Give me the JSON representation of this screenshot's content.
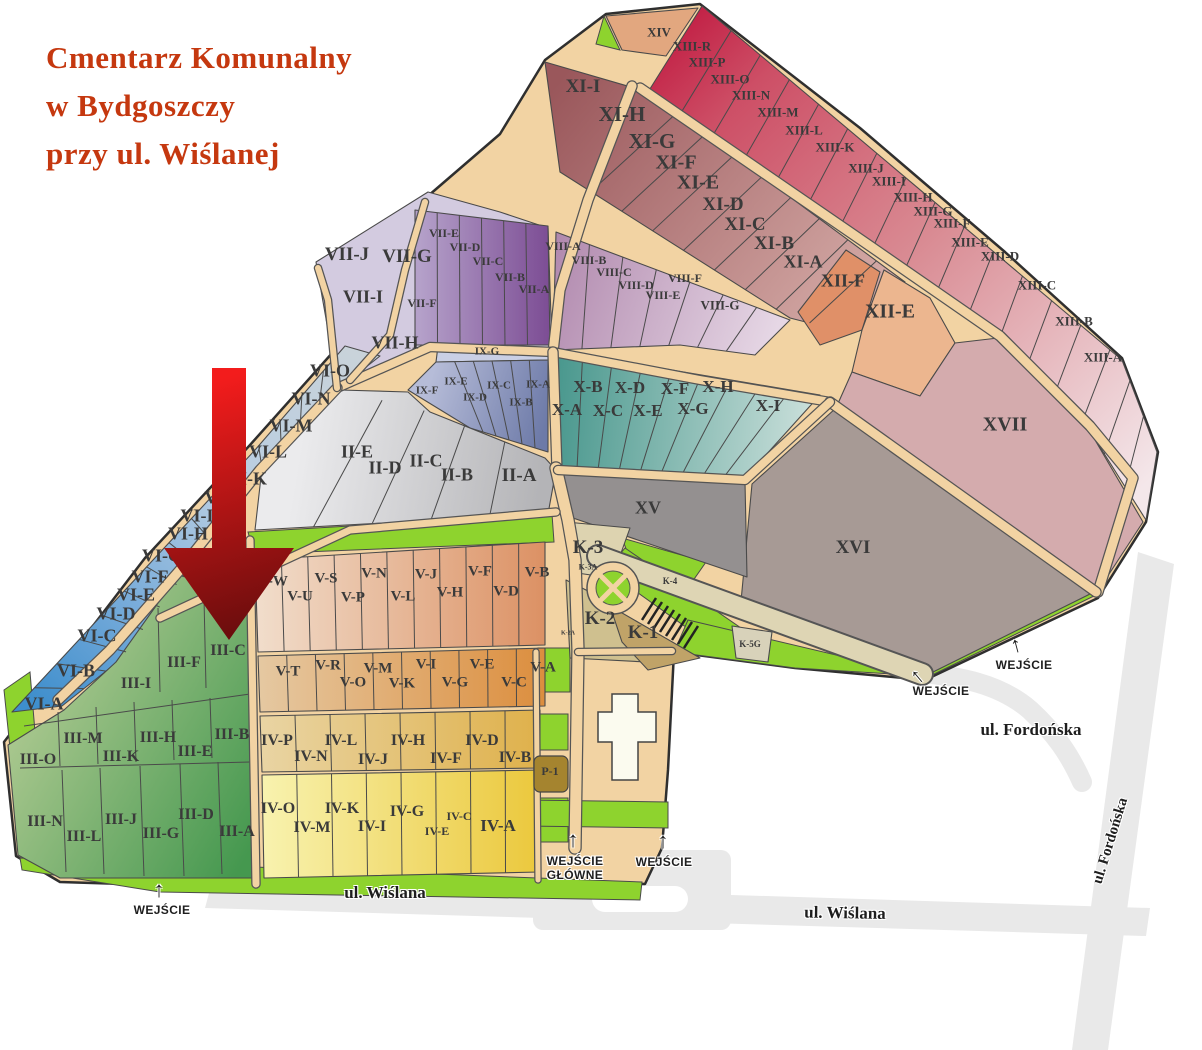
{
  "palette": {
    "title": "#c5380f",
    "label": "#3a3a3a",
    "road": "#f2d3a3",
    "lawn": "#8ed32e",
    "street": "#e9e9e9",
    "arrow_top": "#f31c1c",
    "arrow_bottom": "#6b0d0d"
  },
  "title": {
    "lines": [
      "Cmentarz Komunalny",
      "w Bydgoszczy",
      "przy ul. Wiślanej"
    ]
  },
  "sections": [
    {
      "t": "XIV",
      "x": 659,
      "y": 33,
      "s": 13
    },
    {
      "t": "XIII-R",
      "x": 692,
      "y": 47,
      "s": 13
    },
    {
      "t": "XIII-P",
      "x": 707,
      "y": 63,
      "s": 13
    },
    {
      "t": "XIII-O",
      "x": 730,
      "y": 80,
      "s": 13
    },
    {
      "t": "XIII-N",
      "x": 751,
      "y": 96,
      "s": 13
    },
    {
      "t": "XIII-M",
      "x": 778,
      "y": 113,
      "s": 13
    },
    {
      "t": "XIII-L",
      "x": 804,
      "y": 131,
      "s": 13
    },
    {
      "t": "XIII-K",
      "x": 835,
      "y": 148,
      "s": 13
    },
    {
      "t": "XIII-J",
      "x": 866,
      "y": 169,
      "s": 13
    },
    {
      "t": "XIII-I",
      "x": 889,
      "y": 182,
      "s": 13
    },
    {
      "t": "XIII-H",
      "x": 913,
      "y": 198,
      "s": 13
    },
    {
      "t": "XIII-G",
      "x": 933,
      "y": 212,
      "s": 13
    },
    {
      "t": "XIII-F",
      "x": 952,
      "y": 224,
      "s": 13
    },
    {
      "t": "XIII-E",
      "x": 970,
      "y": 243,
      "s": 13
    },
    {
      "t": "XIII-D",
      "x": 1000,
      "y": 257,
      "s": 13
    },
    {
      "t": "XIII-C",
      "x": 1037,
      "y": 286,
      "s": 13
    },
    {
      "t": "XIII-B",
      "x": 1074,
      "y": 322,
      "s": 13
    },
    {
      "t": "XIII-A",
      "x": 1103,
      "y": 358,
      "s": 13
    },
    {
      "t": "XI-I",
      "x": 583,
      "y": 87,
      "s": 19
    },
    {
      "t": "XI-H",
      "x": 622,
      "y": 114,
      "s": 21
    },
    {
      "t": "XI-G",
      "x": 652,
      "y": 141,
      "s": 21
    },
    {
      "t": "XI-F",
      "x": 676,
      "y": 163,
      "s": 20
    },
    {
      "t": "XI-E",
      "x": 698,
      "y": 183,
      "s": 20
    },
    {
      "t": "XI-D",
      "x": 723,
      "y": 205,
      "s": 19
    },
    {
      "t": "XI-C",
      "x": 745,
      "y": 225,
      "s": 19
    },
    {
      "t": "XI-B",
      "x": 774,
      "y": 244,
      "s": 19
    },
    {
      "t": "XI-A",
      "x": 803,
      "y": 262,
      "s": 18
    },
    {
      "t": "XII-F",
      "x": 843,
      "y": 281,
      "s": 18
    },
    {
      "t": "XII-E",
      "x": 890,
      "y": 312,
      "s": 20
    },
    {
      "t": "XVII",
      "x": 1005,
      "y": 425,
      "s": 20
    },
    {
      "t": "XVI",
      "x": 853,
      "y": 548,
      "s": 19
    },
    {
      "t": "XV",
      "x": 648,
      "y": 508,
      "s": 18
    },
    {
      "t": "VII-J",
      "x": 347,
      "y": 255,
      "s": 19
    },
    {
      "t": "VII-G",
      "x": 407,
      "y": 257,
      "s": 19
    },
    {
      "t": "VII-I",
      "x": 363,
      "y": 297,
      "s": 18
    },
    {
      "t": "VII-E",
      "x": 444,
      "y": 234,
      "s": 12
    },
    {
      "t": "VII-D",
      "x": 465,
      "y": 248,
      "s": 12
    },
    {
      "t": "VII-C",
      "x": 488,
      "y": 262,
      "s": 12
    },
    {
      "t": "VII-B",
      "x": 510,
      "y": 278,
      "s": 12
    },
    {
      "t": "VII-A",
      "x": 534,
      "y": 290,
      "s": 12
    },
    {
      "t": "VII-F",
      "x": 422,
      "y": 304,
      "s": 12
    },
    {
      "t": "VII-H",
      "x": 395,
      "y": 343,
      "s": 18
    },
    {
      "t": "VIII-A",
      "x": 563,
      "y": 247,
      "s": 12
    },
    {
      "t": "VIII-B",
      "x": 589,
      "y": 261,
      "s": 12
    },
    {
      "t": "VIII-C",
      "x": 614,
      "y": 273,
      "s": 12
    },
    {
      "t": "VIII-D",
      "x": 636,
      "y": 286,
      "s": 12
    },
    {
      "t": "VIII-E",
      "x": 663,
      "y": 296,
      "s": 12
    },
    {
      "t": "VIII-F",
      "x": 685,
      "y": 279,
      "s": 12
    },
    {
      "t": "VIII-G",
      "x": 720,
      "y": 306,
      "s": 13
    },
    {
      "t": "IX-G",
      "x": 487,
      "y": 352,
      "s": 11
    },
    {
      "t": "IX-F",
      "x": 427,
      "y": 391,
      "s": 11
    },
    {
      "t": "IX-E",
      "x": 456,
      "y": 382,
      "s": 11
    },
    {
      "t": "IX-D",
      "x": 475,
      "y": 398,
      "s": 11
    },
    {
      "t": "IX-C",
      "x": 499,
      "y": 386,
      "s": 11
    },
    {
      "t": "IX-B",
      "x": 521,
      "y": 403,
      "s": 11
    },
    {
      "t": "IX-A",
      "x": 538,
      "y": 385,
      "s": 11
    },
    {
      "t": "X-A",
      "x": 567,
      "y": 410,
      "s": 17
    },
    {
      "t": "X-B",
      "x": 588,
      "y": 387,
      "s": 17
    },
    {
      "t": "X-C",
      "x": 608,
      "y": 411,
      "s": 17
    },
    {
      "t": "X-D",
      "x": 630,
      "y": 388,
      "s": 17
    },
    {
      "t": "X-E",
      "x": 648,
      "y": 411,
      "s": 17
    },
    {
      "t": "X-F",
      "x": 675,
      "y": 389,
      "s": 17
    },
    {
      "t": "X-G",
      "x": 693,
      "y": 409,
      "s": 17
    },
    {
      "t": "X-H",
      "x": 718,
      "y": 387,
      "s": 17
    },
    {
      "t": "X-I",
      "x": 768,
      "y": 406,
      "s": 17
    },
    {
      "t": "VI-O",
      "x": 330,
      "y": 371,
      "s": 18
    },
    {
      "t": "VI-N",
      "x": 311,
      "y": 399,
      "s": 18
    },
    {
      "t": "VI-M",
      "x": 291,
      "y": 426,
      "s": 18
    },
    {
      "t": "VI-L",
      "x": 268,
      "y": 452,
      "s": 18
    },
    {
      "t": "VI-K",
      "x": 247,
      "y": 479,
      "s": 18
    },
    {
      "t": "VI-J",
      "x": 222,
      "y": 498,
      "s": 18
    },
    {
      "t": "VI-I",
      "x": 197,
      "y": 516,
      "s": 18
    },
    {
      "t": "VI-H",
      "x": 188,
      "y": 534,
      "s": 18
    },
    {
      "t": "VI-G",
      "x": 162,
      "y": 556,
      "s": 18
    },
    {
      "t": "VI-F",
      "x": 150,
      "y": 577,
      "s": 18
    },
    {
      "t": "VI-E",
      "x": 136,
      "y": 595,
      "s": 18
    },
    {
      "t": "VI-D",
      "x": 116,
      "y": 614,
      "s": 18
    },
    {
      "t": "VI-C",
      "x": 97,
      "y": 636,
      "s": 18
    },
    {
      "t": "VI-B",
      "x": 76,
      "y": 671,
      "s": 18
    },
    {
      "t": "VI-A",
      "x": 44,
      "y": 704,
      "s": 18
    },
    {
      "t": "II-E",
      "x": 357,
      "y": 452,
      "s": 18
    },
    {
      "t": "II-D",
      "x": 385,
      "y": 468,
      "s": 18
    },
    {
      "t": "II-C",
      "x": 426,
      "y": 461,
      "s": 18
    },
    {
      "t": "II-B",
      "x": 457,
      "y": 475,
      "s": 18
    },
    {
      "t": "II-A",
      "x": 519,
      "y": 476,
      "s": 19
    },
    {
      "t": "K-3",
      "x": 588,
      "y": 548,
      "s": 19
    },
    {
      "t": "K-3A",
      "x": 588,
      "y": 567,
      "s": 8
    },
    {
      "t": "K-4",
      "x": 670,
      "y": 581,
      "s": 9
    },
    {
      "t": "K-2",
      "x": 600,
      "y": 619,
      "s": 19
    },
    {
      "t": "K-1",
      "x": 643,
      "y": 633,
      "s": 19
    },
    {
      "t": "K-2A",
      "x": 568,
      "y": 634,
      "s": 6
    },
    {
      "t": "K-5G",
      "x": 750,
      "y": 644,
      "s": 9
    },
    {
      "t": "V-W",
      "x": 273,
      "y": 582,
      "s": 15
    },
    {
      "t": "V-U",
      "x": 300,
      "y": 597,
      "s": 15
    },
    {
      "t": "V-S",
      "x": 326,
      "y": 579,
      "s": 15
    },
    {
      "t": "V-P",
      "x": 353,
      "y": 598,
      "s": 15
    },
    {
      "t": "V-N",
      "x": 374,
      "y": 574,
      "s": 15
    },
    {
      "t": "V-L",
      "x": 403,
      "y": 597,
      "s": 15
    },
    {
      "t": "V-J",
      "x": 426,
      "y": 575,
      "s": 15
    },
    {
      "t": "V-H",
      "x": 450,
      "y": 593,
      "s": 15
    },
    {
      "t": "V-F",
      "x": 480,
      "y": 572,
      "s": 15
    },
    {
      "t": "V-D",
      "x": 506,
      "y": 592,
      "s": 15
    },
    {
      "t": "V-B",
      "x": 537,
      "y": 573,
      "s": 15
    },
    {
      "t": "V-T",
      "x": 288,
      "y": 672,
      "s": 15
    },
    {
      "t": "V-R",
      "x": 328,
      "y": 666,
      "s": 15
    },
    {
      "t": "V-O",
      "x": 353,
      "y": 683,
      "s": 15
    },
    {
      "t": "V-M",
      "x": 378,
      "y": 669,
      "s": 15
    },
    {
      "t": "V-K",
      "x": 402,
      "y": 684,
      "s": 15
    },
    {
      "t": "V-I",
      "x": 426,
      "y": 665,
      "s": 15
    },
    {
      "t": "V-G",
      "x": 455,
      "y": 683,
      "s": 15
    },
    {
      "t": "V-E",
      "x": 482,
      "y": 665,
      "s": 15
    },
    {
      "t": "V-C",
      "x": 514,
      "y": 683,
      "s": 15
    },
    {
      "t": "V-A",
      "x": 543,
      "y": 668,
      "s": 15
    },
    {
      "t": "IV-P",
      "x": 277,
      "y": 741,
      "s": 16
    },
    {
      "t": "IV-N",
      "x": 311,
      "y": 757,
      "s": 16
    },
    {
      "t": "IV-L",
      "x": 341,
      "y": 741,
      "s": 16
    },
    {
      "t": "IV-J",
      "x": 373,
      "y": 760,
      "s": 16
    },
    {
      "t": "IV-H",
      "x": 408,
      "y": 741,
      "s": 16
    },
    {
      "t": "IV-F",
      "x": 446,
      "y": 759,
      "s": 16
    },
    {
      "t": "IV-D",
      "x": 482,
      "y": 741,
      "s": 16
    },
    {
      "t": "IV-B",
      "x": 515,
      "y": 758,
      "s": 16
    },
    {
      "t": "P-1",
      "x": 550,
      "y": 772,
      "s": 12
    },
    {
      "t": "IV-O",
      "x": 278,
      "y": 809,
      "s": 16
    },
    {
      "t": "IV-M",
      "x": 312,
      "y": 828,
      "s": 16
    },
    {
      "t": "IV-K",
      "x": 342,
      "y": 809,
      "s": 16
    },
    {
      "t": "IV-I",
      "x": 372,
      "y": 827,
      "s": 16
    },
    {
      "t": "IV-G",
      "x": 407,
      "y": 812,
      "s": 16
    },
    {
      "t": "IV-E",
      "x": 437,
      "y": 832,
      "s": 12
    },
    {
      "t": "IV-C",
      "x": 459,
      "y": 817,
      "s": 12
    },
    {
      "t": "IV-A",
      "x": 498,
      "y": 826,
      "s": 17
    },
    {
      "t": "III-C",
      "x": 228,
      "y": 651,
      "s": 16
    },
    {
      "t": "III-F",
      "x": 184,
      "y": 663,
      "s": 16
    },
    {
      "t": "III-I",
      "x": 136,
      "y": 684,
      "s": 16
    },
    {
      "t": "III-O",
      "x": 38,
      "y": 760,
      "s": 16
    },
    {
      "t": "III-M",
      "x": 83,
      "y": 739,
      "s": 16
    },
    {
      "t": "III-K",
      "x": 121,
      "y": 757,
      "s": 16
    },
    {
      "t": "III-H",
      "x": 158,
      "y": 738,
      "s": 16
    },
    {
      "t": "III-E",
      "x": 195,
      "y": 752,
      "s": 16
    },
    {
      "t": "III-B",
      "x": 232,
      "y": 735,
      "s": 16
    },
    {
      "t": "III-N",
      "x": 45,
      "y": 822,
      "s": 16
    },
    {
      "t": "III-L",
      "x": 84,
      "y": 837,
      "s": 16
    },
    {
      "t": "III-J",
      "x": 121,
      "y": 820,
      "s": 16
    },
    {
      "t": "III-G",
      "x": 161,
      "y": 834,
      "s": 16
    },
    {
      "t": "III-D",
      "x": 196,
      "y": 815,
      "s": 16
    },
    {
      "t": "III-A",
      "x": 237,
      "y": 832,
      "s": 16
    }
  ],
  "streets": [
    {
      "name": "ul. Wiślana",
      "x": 385,
      "y": 893,
      "s": 17,
      "rot": 0
    },
    {
      "name": "ul. Wiślana",
      "x": 845,
      "y": 913,
      "s": 17,
      "rot": 1
    },
    {
      "name": "ul. Fordońska",
      "x": 1031,
      "y": 730,
      "s": 17,
      "rot": 0
    },
    {
      "name": "ul. Fordońska",
      "x": 1111,
      "y": 841,
      "s": 15,
      "rot": -73
    }
  ],
  "entrances": [
    {
      "label": "WEJŚCIE\nGŁÓWNE",
      "x": 575,
      "y": 869,
      "ax": 573,
      "ay": 840,
      "rot": 0
    },
    {
      "label": "WEJŚCIE",
      "x": 664,
      "y": 863,
      "ax": 663,
      "ay": 841,
      "rot": 0
    },
    {
      "label": "WEJŚCIE",
      "x": 162,
      "y": 911,
      "ax": 159,
      "ay": 890,
      "rot": 0
    },
    {
      "label": "WEJŚCIE",
      "x": 1024,
      "y": 666,
      "ax": 1016,
      "ay": 645,
      "rot": -15
    },
    {
      "label": "WEJŚCIE",
      "x": 941,
      "y": 692,
      "ax": 917,
      "ay": 676,
      "rot": -40
    }
  ]
}
